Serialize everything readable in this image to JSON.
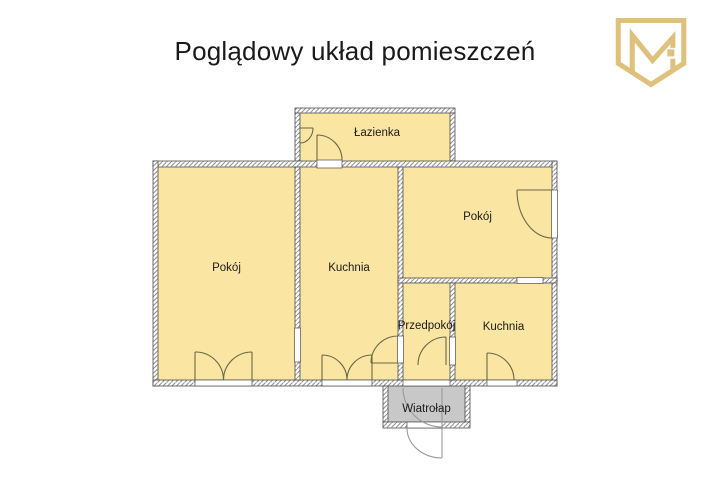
{
  "title": "Poglądowy układ pomieszczeń",
  "logo": {
    "icon": "m-shield-logo",
    "color": "#DFC17E"
  },
  "floor_plan": {
    "rooms": [
      {
        "id": "lazienka",
        "label": "Łazienka"
      },
      {
        "id": "pokoj-left",
        "label": "Pokój"
      },
      {
        "id": "kuchnia-center",
        "label": "Kuchnia"
      },
      {
        "id": "pokoj-right",
        "label": "Pokój"
      },
      {
        "id": "przedpokoj",
        "label": "Przedpokój"
      },
      {
        "id": "kuchnia-right",
        "label": "Kuchnia"
      },
      {
        "id": "wiatrolap",
        "label": "Wiatrołap"
      }
    ],
    "colors": {
      "room_fill": "#FAE5A2",
      "vestibule_fill": "#C8C8C8",
      "wall_fill": "#FFFFFF",
      "wall_hatch": "#909090",
      "wall_outline": "#4D4D4D",
      "door_arc": "#6B6847",
      "entry_door": "#9A9A9A",
      "text": "#1A1A1A",
      "background": "#FFFFFF"
    }
  }
}
